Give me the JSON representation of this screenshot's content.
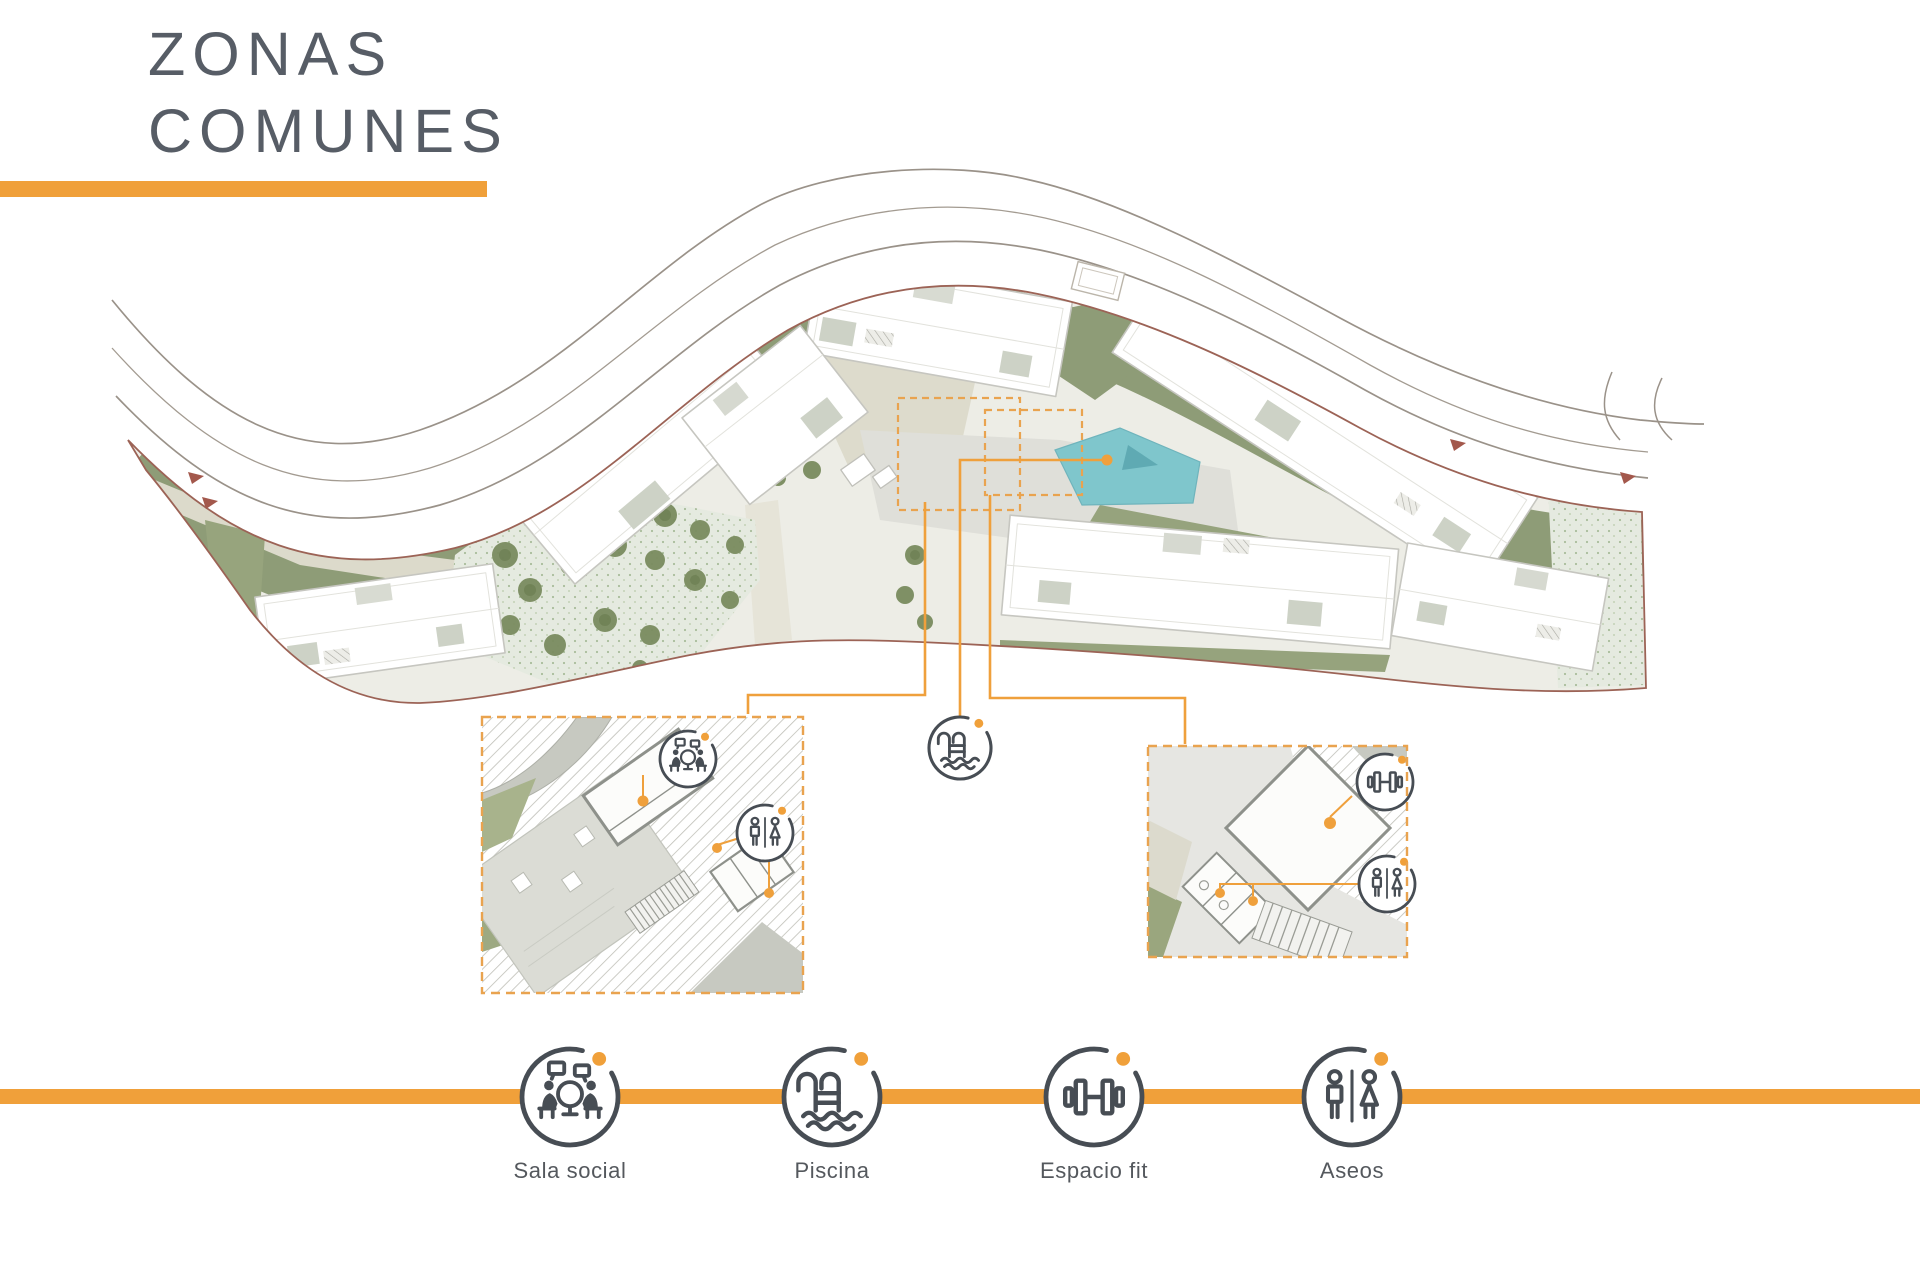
{
  "title": {
    "line1": "ZONAS",
    "line2": "COMUNES"
  },
  "legend": {
    "items": [
      {
        "label": "Sala social",
        "icon": "meeting-icon"
      },
      {
        "label": "Piscina",
        "icon": "pool-ladder-icon"
      },
      {
        "label": "Espacio fit",
        "icon": "dumbbell-icon"
      },
      {
        "label": "Aseos",
        "icon": "restroom-icon"
      }
    ]
  },
  "site_plan": {
    "amenity_markers": [
      {
        "name": "sala-social",
        "icon": "meeting-icon",
        "location": "left-detail-inset"
      },
      {
        "name": "piscina",
        "icon": "pool-ladder-icon",
        "location": "center-of-plan"
      },
      {
        "name": "espacio-fit",
        "icon": "dumbbell-icon",
        "location": "right-detail-inset"
      },
      {
        "name": "aseos",
        "icon": "restroom-icon",
        "location": "both-detail-insets"
      }
    ]
  },
  "colors": {
    "accent_orange": "#F0A03A",
    "connector_orange": "#EFA03C",
    "dashed_zone_orange": "#E9A34F",
    "title_gray": "#575D66",
    "label_gray": "#54585D",
    "icon_gray": "#474D54",
    "pool_teal": "#7FC6CC",
    "boundary_brown": "#9C6356",
    "olive_green": "#8E9C77",
    "tree_green": "#74875A"
  }
}
